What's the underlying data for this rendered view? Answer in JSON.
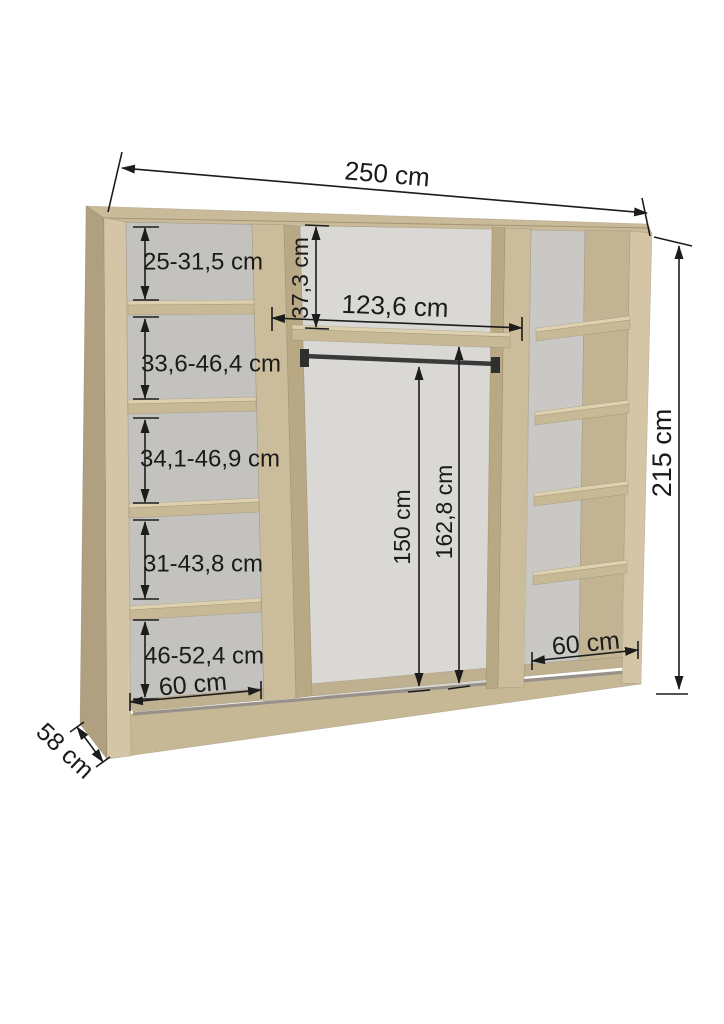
{
  "diagram": {
    "type": "wardrobe-interior-dimension-diagram",
    "unit": "cm",
    "colors": {
      "background": "#ffffff",
      "dimension_line": "#1c1c1c",
      "wood_top": "#c9ba99",
      "wood_front": "#d3c5a5",
      "wood_side_shaded": "#b0a080",
      "wood_divider": "#cbbd9c",
      "wood_divider_side": "#b8a884",
      "wood_shelf": "#c7b896",
      "wood_shelf_top": "#ddd0af",
      "wood_inner_right": "#c2b392",
      "wood_floor": "#bfb08f",
      "wood_plinth": "#c6b795",
      "back_left": "#c3c2be",
      "back_middle": "#d9d8d4",
      "back_right": "#c9c8c4",
      "track_gray": "#97918a",
      "rail_dark": "#3a3a3a"
    },
    "dimensions": {
      "total_width": "250 cm",
      "total_height": "215 cm",
      "depth": "58 cm",
      "top_shelf_height": "37,3 cm",
      "middle_inner_width": "123,6 cm",
      "hanging_rod_height": "150 cm",
      "middle_inner_height": "162,8 cm",
      "left_column_width": "60 cm",
      "right_column_width": "60 cm",
      "left_shelf_ranges": [
        "25-31,5 cm",
        "33,6-46,4 cm",
        "34,1-46,9 cm",
        "31-43,8 cm",
        "46-52,4 cm"
      ]
    }
  }
}
